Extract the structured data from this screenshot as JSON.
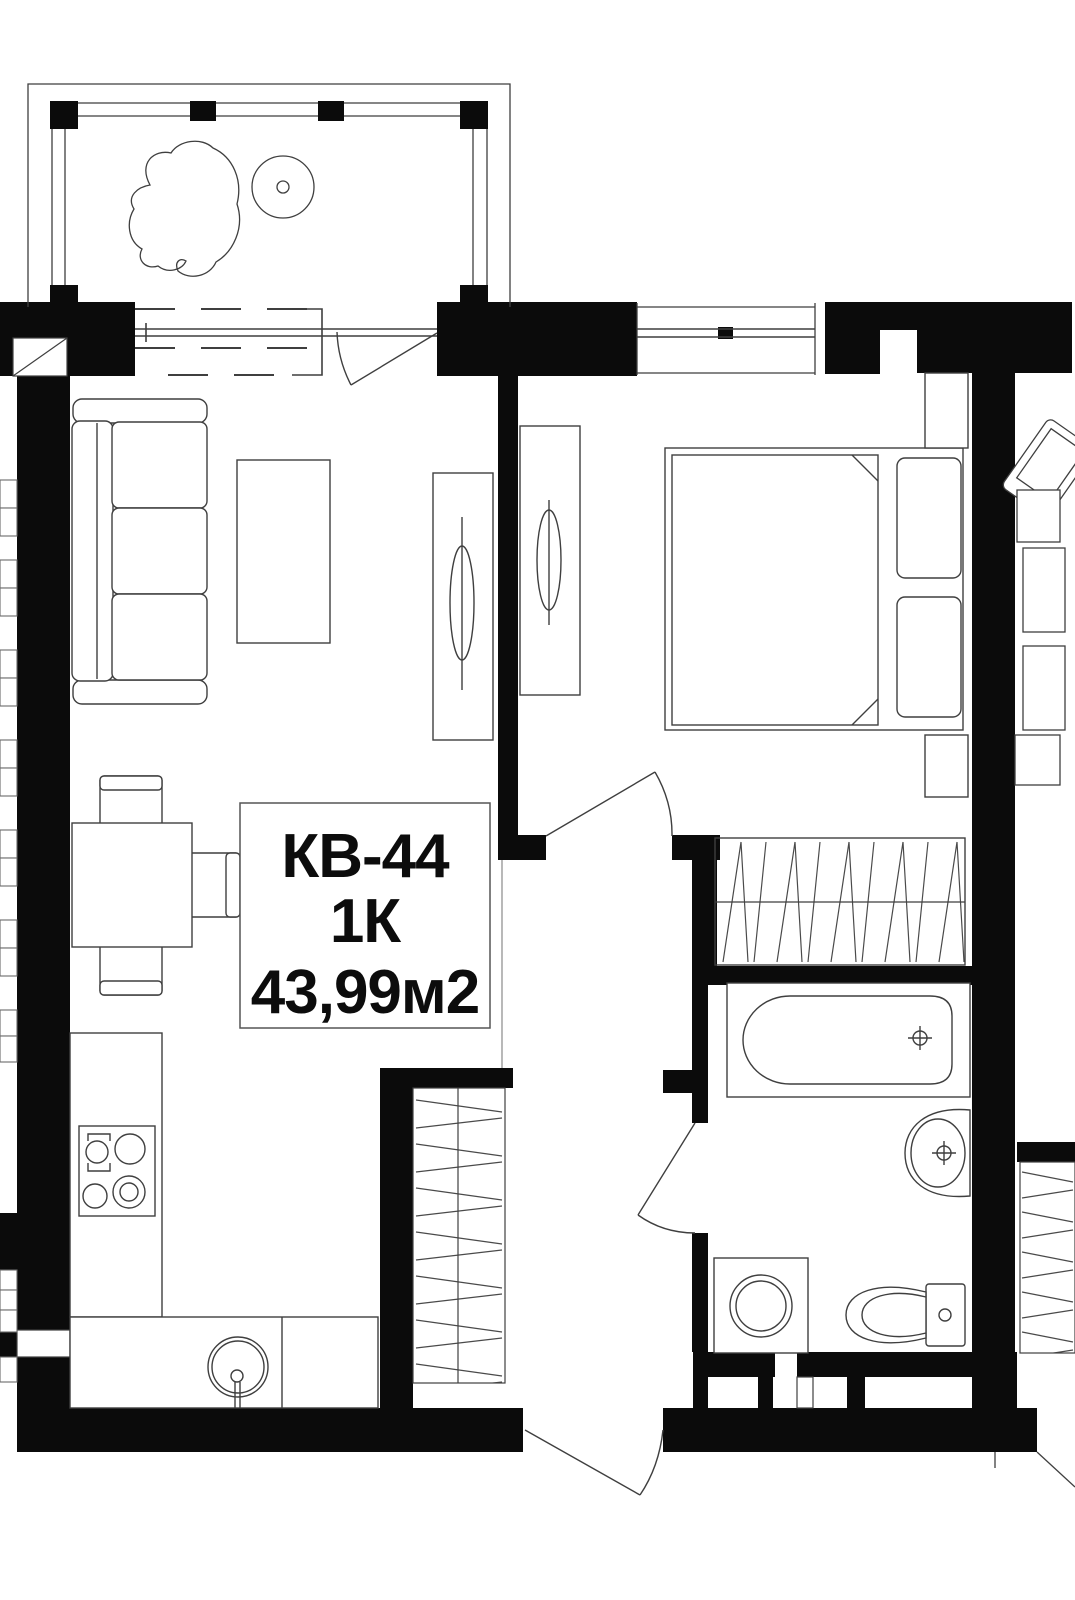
{
  "plan": {
    "unit_label": "КВ-44",
    "rooms_label": "1К",
    "area_label": "43,99м2"
  },
  "colors": {
    "wall": "#0b0b0b",
    "line": "#3f3f3f",
    "background": "#ffffff"
  }
}
